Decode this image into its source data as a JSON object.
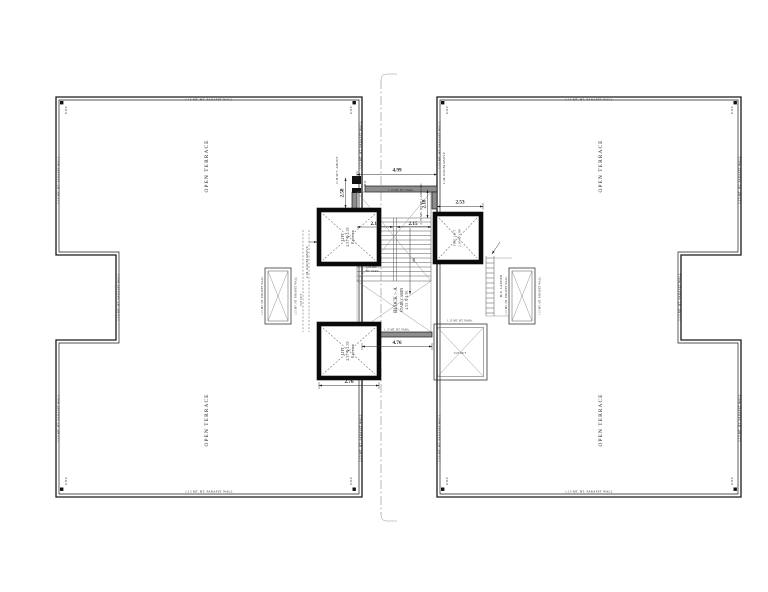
{
  "labels": {
    "parapet_wall": "1.15 MT. HT. PARAPET WALL",
    "parapet_short": "1.15 MT. HT. PARA.",
    "para_mt": "1.15 MT.",
    "para_ht": "HT. PARA.",
    "open_terrace": "OPEN TERRACE",
    "rwp": "R.W.P.",
    "lift_line1": "LIFT",
    "lift_line2": "2.57 X 2.39",
    "lift_line3": "8 person",
    "fire_lift_line1": "FIRE LIFT",
    "fire_lift_line2": "2.05 X 1.98",
    "block_line1": "BLOCK :- A",
    "block_line2": "STAIR CABIN",
    "block_line3": "4.53 X 1.93",
    "landing": "2.15 MT. WIDE LANDING",
    "ms_ladder": "M.S. LADDER",
    "lm_room": "L.M. ROOM ABOVE",
    "ohwt": "O.H.W.T. ABOVE",
    "cut_out": "CUT OUT",
    "dn": "dn",
    "md": "M.D."
  },
  "dims": {
    "top_width": "4.99",
    "left_height": "2.58",
    "right_height": "2.18",
    "fire_lift_width": "2.53",
    "flight_a": "2.15",
    "flight_b": "2.15",
    "bottom_width": "4.76",
    "lift_width": "2.76"
  },
  "colors": {
    "ink": "#1a1a1a",
    "wall_fill": "#8d8d8d",
    "background": "#ffffff"
  }
}
